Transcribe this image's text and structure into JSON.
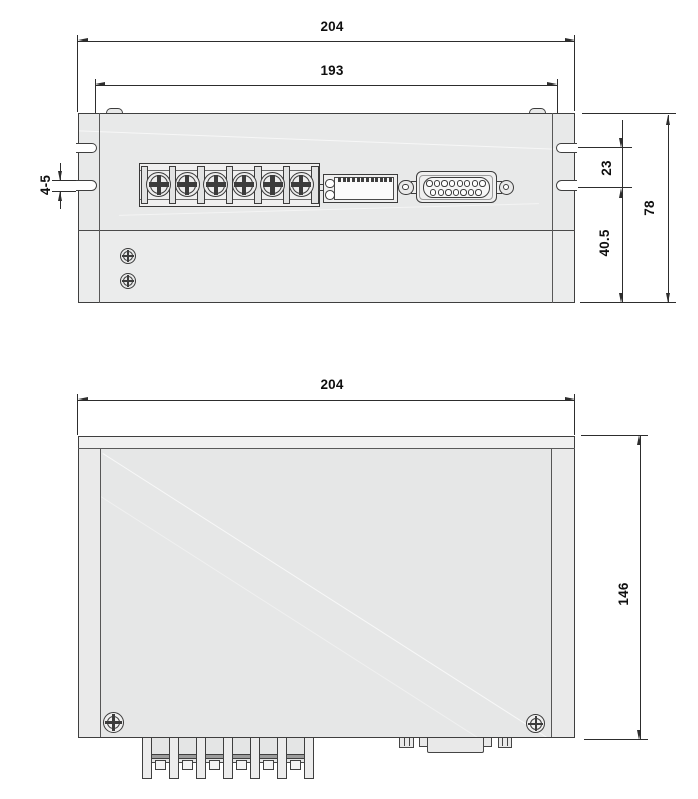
{
  "meta": {
    "type": "technical-dimension-drawing",
    "views": 2
  },
  "colors": {
    "background": "#ffffff",
    "outline": "#3f3f3f",
    "dimension_line": "#2d2d2d",
    "dimension_text": "#0f0f0f",
    "body_fill": "#e8e9e9",
    "panel_fill": "#e6e7e7",
    "block_fill": "#f0f0f0"
  },
  "top_view": {
    "dimensions": {
      "overall_width": "204",
      "slot_span": "193",
      "slot_width": "4-5",
      "slot_spacing": "23",
      "base_depth": "40.5",
      "overall_depth": "78"
    },
    "features": {
      "terminal_screw_count": 6,
      "dip_switch_count": 12,
      "led_count": 2,
      "dsub_top_row_holes": 8,
      "dsub_bottom_row_holes": 7,
      "case_screw_count": 2
    }
  },
  "front_view": {
    "dimensions": {
      "overall_width": "204",
      "overall_height": "146"
    },
    "features": {
      "corner_screw_count": 2,
      "terminal_pin_count": 7,
      "terminal_bay_count": 6
    }
  }
}
